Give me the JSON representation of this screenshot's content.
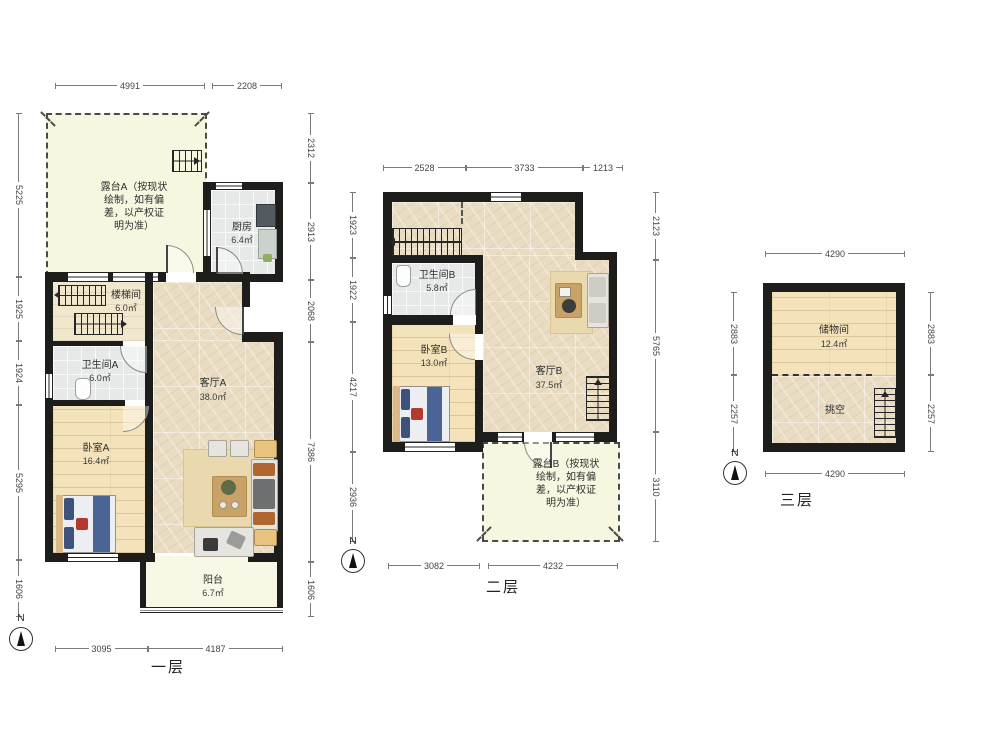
{
  "document": {
    "type": "floor-plan",
    "compass_letter": "N",
    "floor1": {
      "title": "一层",
      "rooms": {
        "terrace": {
          "label": "露台A（按现状\n绘制，如有偏\n差，以产权证\n明为准）"
        },
        "kitchen": {
          "name": "厨房",
          "area": "6.4㎡"
        },
        "stairwell": {
          "name": "楼梯间",
          "area": "6.0㎡"
        },
        "bathroom": {
          "name": "卫生间A",
          "area": "6.0㎡"
        },
        "bedroom": {
          "name": "卧室A",
          "area": "16.4㎡"
        },
        "living": {
          "name": "客厅A",
          "area": "38.0㎡"
        },
        "balcony": {
          "name": "阳台",
          "area": "6.7㎡"
        }
      },
      "dims": {
        "top": [
          "4991",
          "2208"
        ],
        "left": [
          "5225",
          "1925",
          "1924",
          "5295",
          "1606"
        ],
        "right": [
          "2312",
          "2913",
          "2068",
          "7386",
          "1606"
        ],
        "bottom": [
          "3095",
          "4187"
        ]
      }
    },
    "floor2": {
      "title": "二层",
      "rooms": {
        "bathroom": {
          "name": "卫生间B",
          "area": "5.8㎡"
        },
        "bedroom": {
          "name": "卧室B",
          "area": "13.0㎡"
        },
        "living": {
          "name": "客厅B",
          "area": "37.5㎡"
        },
        "terrace": {
          "label": "露台B（按现状\n绘制，如有偏\n差，以产权证\n明为准）"
        }
      },
      "dims": {
        "top": [
          "2528",
          "3733",
          "1213"
        ],
        "left": [
          "1923",
          "1922",
          "4217",
          "2936"
        ],
        "right": [
          "2123",
          "5765",
          "3110"
        ],
        "bottom": [
          "3082",
          "4232"
        ]
      }
    },
    "floor3": {
      "title": "三层",
      "rooms": {
        "storage": {
          "name": "储物间",
          "area": "12.4㎡"
        },
        "void": {
          "name": "挑空"
        }
      },
      "dims": {
        "top": [
          "4290"
        ],
        "left": [
          "2883",
          "2257"
        ],
        "right": [
          "2883",
          "2257"
        ],
        "bottom": [
          "4290"
        ]
      }
    }
  }
}
